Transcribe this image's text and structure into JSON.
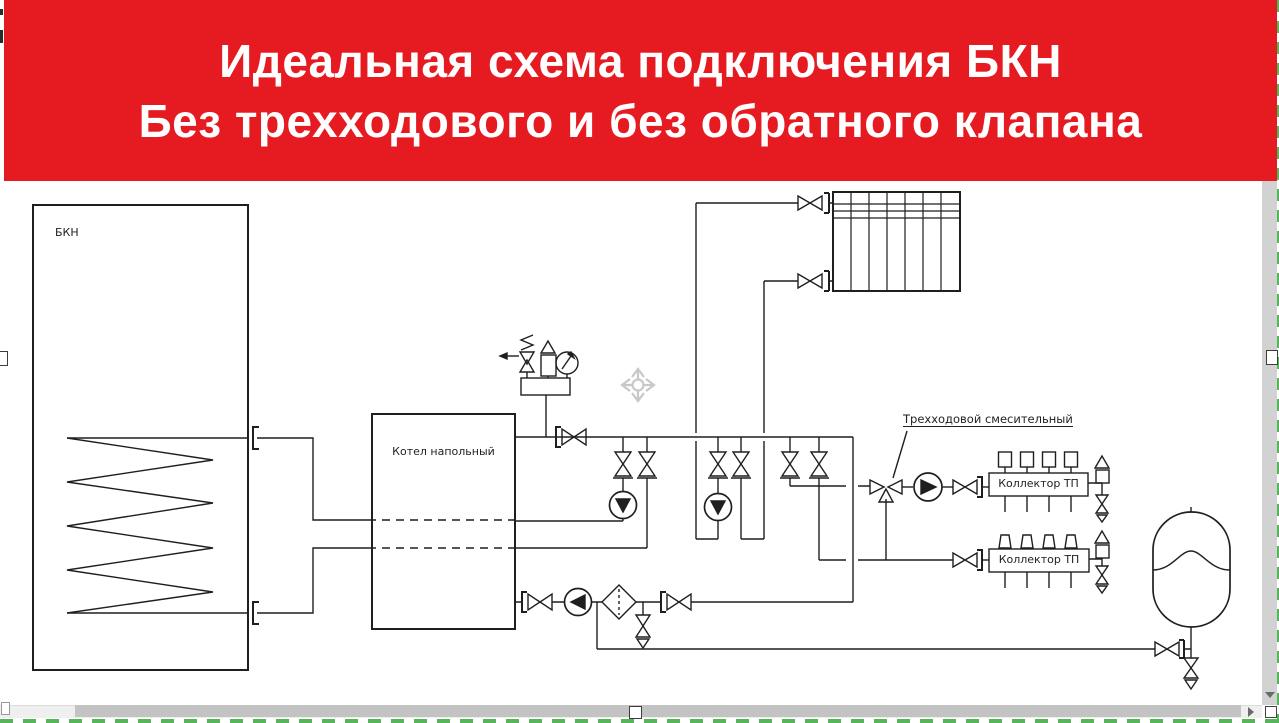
{
  "banner": {
    "line1": "Идеальная схема подключения БКН",
    "line2": "Без трехходового и без обратного клапана",
    "bg_color": "#e61b22",
    "text_color": "#ffffff"
  },
  "diagram": {
    "line_color": "#1f1f1f",
    "labels": {
      "tank": "БКН",
      "boiler": "Котел напольный",
      "three_way": "Трехходовой смесительный",
      "collector_top": "Коллектор ТП",
      "collector_bottom": "Коллектор ТП"
    }
  },
  "editor": {
    "selection_color": "#57b45b",
    "scrollbar": {
      "down_arrow_icon": "triangle-down",
      "right_arrow_icon": "triangle-right"
    }
  }
}
